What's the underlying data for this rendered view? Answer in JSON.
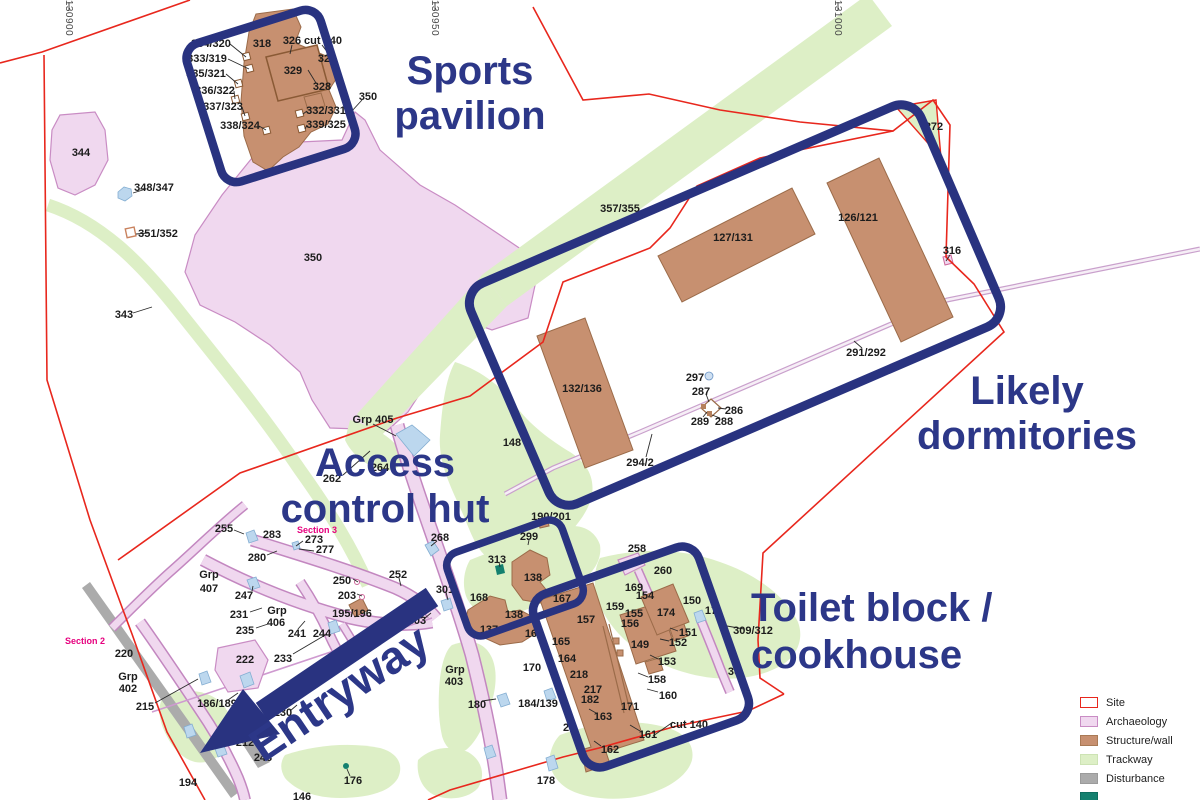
{
  "colors": {
    "annotation": "#2c3788",
    "highlight_box": "#293380",
    "site_boundary": "#e8271d",
    "archaeology": "#f0d8ef",
    "structure": "#c79070",
    "trackway": "#ddefc6",
    "disturbance": "#ababab",
    "section_label": "#e6007e",
    "teal": "#14806f"
  },
  "grid_labels": [
    {
      "text": "130900",
      "x": 66,
      "y": 18
    },
    {
      "text": "130950",
      "x": 432,
      "y": 18
    },
    {
      "text": "131000",
      "x": 835,
      "y": 18
    }
  ],
  "annotations": [
    {
      "name": "sports-pavilion",
      "lines": [
        "Sports",
        "pavilion"
      ],
      "x": 470,
      "y": 84,
      "size": 40,
      "lh": 45,
      "anchor": "middle",
      "rotate": 0
    },
    {
      "name": "likely-dormitories",
      "lines": [
        "Likely",
        "dormitories"
      ],
      "x": 1027,
      "y": 404,
      "size": 40,
      "lh": 45,
      "anchor": "middle",
      "rotate": 0
    },
    {
      "name": "access-control-hut",
      "lines": [
        "Access",
        "control hut"
      ],
      "x": 385,
      "y": 476,
      "size": 40,
      "lh": 46,
      "anchor": "middle",
      "rotate": 0
    },
    {
      "name": "toilet-block-cookhouse",
      "lines": [
        "Toilet block /",
        "cookhouse"
      ],
      "x": 751,
      "y": 621,
      "size": 40,
      "lh": 47,
      "anchor": "start",
      "rotate": 0
    },
    {
      "name": "entryway",
      "lines": [
        "Entryway"
      ],
      "x": 348,
      "y": 706,
      "size": 46,
      "lh": 46,
      "anchor": "middle",
      "rotate": -34
    }
  ],
  "legend": {
    "items": [
      {
        "label": "Site",
        "fill": "#ffffff",
        "border": "#e8271d"
      },
      {
        "label": "Archaeology",
        "fill": "#f0d8ef",
        "border": "#c98cc4"
      },
      {
        "label": "Structure/wall",
        "fill": "#c79070",
        "border": "#a97a55"
      },
      {
        "label": "Trackway",
        "fill": "#ddefc6",
        "border": "#cde3b4"
      },
      {
        "label": "Disturbance",
        "fill": "#ababab",
        "border": "#9b9b9b"
      },
      {
        "label": "",
        "fill": "#14806f",
        "border": "#0e6e60"
      }
    ]
  },
  "map_labels": [
    {
      "t": "334/320",
      "x": 211,
      "y": 43
    },
    {
      "t": "333/319",
      "x": 207,
      "y": 58
    },
    {
      "t": "335/321",
      "x": 206,
      "y": 73
    },
    {
      "t": "336/322",
      "x": 215,
      "y": 90
    },
    {
      "t": "337/323",
      "x": 223,
      "y": 106
    },
    {
      "t": "338/324",
      "x": 240,
      "y": 125
    },
    {
      "t": "318",
      "x": 262,
      "y": 43
    },
    {
      "t": "326",
      "x": 292,
      "y": 40
    },
    {
      "t": "cut 140",
      "x": 323,
      "y": 40
    },
    {
      "t": "32",
      "x": 324,
      "y": 58
    },
    {
      "t": "329",
      "x": 293,
      "y": 70
    },
    {
      "t": "328",
      "x": 322,
      "y": 86
    },
    {
      "t": "332/331",
      "x": 326,
      "y": 110
    },
    {
      "t": "339/325",
      "x": 326,
      "y": 124
    },
    {
      "t": "350",
      "x": 368,
      "y": 96
    },
    {
      "t": "344",
      "x": 81,
      "y": 152
    },
    {
      "t": "348/347",
      "x": 154,
      "y": 187
    },
    {
      "t": "351/352",
      "x": 158,
      "y": 233
    },
    {
      "t": "343",
      "x": 124,
      "y": 314
    },
    {
      "t": "350",
      "x": 313,
      "y": 257
    },
    {
      "t": "357/355",
      "x": 620,
      "y": 208
    },
    {
      "t": "127/131",
      "x": 733,
      "y": 237
    },
    {
      "t": "126/121",
      "x": 858,
      "y": 217
    },
    {
      "t": "316",
      "x": 952,
      "y": 250
    },
    {
      "t": "272",
      "x": 934,
      "y": 126
    },
    {
      "t": "291/292",
      "x": 866,
      "y": 352
    },
    {
      "t": "132/136",
      "x": 582,
      "y": 388
    },
    {
      "t": "297",
      "x": 695,
      "y": 377
    },
    {
      "t": "287",
      "x": 701,
      "y": 391
    },
    {
      "t": "286",
      "x": 734,
      "y": 410
    },
    {
      "t": "289",
      "x": 700,
      "y": 421
    },
    {
      "t": "288",
      "x": 724,
      "y": 421
    },
    {
      "t": "294/2",
      "x": 640,
      "y": 462
    },
    {
      "t": "148",
      "x": 512,
      "y": 442
    },
    {
      "t": "Grp 405",
      "x": 373,
      "y": 419
    },
    {
      "t": "262",
      "x": 332,
      "y": 478
    },
    {
      "t": "264",
      "x": 380,
      "y": 467
    },
    {
      "t": "255",
      "x": 224,
      "y": 528
    },
    {
      "t": "283",
      "x": 272,
      "y": 534
    },
    {
      "t": "Section 3",
      "x": 317,
      "y": 529,
      "c": "magenta"
    },
    {
      "t": "273",
      "x": 314,
      "y": 539
    },
    {
      "t": "277",
      "x": 325,
      "y": 549
    },
    {
      "t": "280",
      "x": 257,
      "y": 557
    },
    {
      "t": "268",
      "x": 440,
      "y": 537
    },
    {
      "t": "Grp",
      "x": 209,
      "y": 574
    },
    {
      "t": "407",
      "x": 209,
      "y": 588
    },
    {
      "t": "247",
      "x": 244,
      "y": 595
    },
    {
      "t": "231",
      "x": 239,
      "y": 614
    },
    {
      "t": "235",
      "x": 245,
      "y": 630
    },
    {
      "t": "Grp",
      "x": 277,
      "y": 610
    },
    {
      "t": "406",
      "x": 276,
      "y": 622
    },
    {
      "t": "241",
      "x": 297,
      "y": 633
    },
    {
      "t": "244",
      "x": 322,
      "y": 633
    },
    {
      "t": "250",
      "x": 342,
      "y": 580
    },
    {
      "t": "203",
      "x": 347,
      "y": 595
    },
    {
      "t": "195/196",
      "x": 352,
      "y": 613
    },
    {
      "t": "252",
      "x": 398,
      "y": 574
    },
    {
      "t": "301",
      "x": 445,
      "y": 589
    },
    {
      "t": "303",
      "x": 417,
      "y": 620
    },
    {
      "t": "222",
      "x": 245,
      "y": 659
    },
    {
      "t": "233",
      "x": 283,
      "y": 658
    },
    {
      "t": "220",
      "x": 124,
      "y": 653
    },
    {
      "t": "Section 2",
      "x": 85,
      "y": 640,
      "c": "magenta"
    },
    {
      "t": "Grp",
      "x": 128,
      "y": 676
    },
    {
      "t": "402",
      "x": 128,
      "y": 688
    },
    {
      "t": "215",
      "x": 145,
      "y": 706
    },
    {
      "t": "186/189",
      "x": 217,
      "y": 703
    },
    {
      "t": "230",
      "x": 283,
      "y": 712
    },
    {
      "t": "212",
      "x": 245,
      "y": 742
    },
    {
      "t": "243",
      "x": 263,
      "y": 757
    },
    {
      "t": "194",
      "x": 188,
      "y": 782
    },
    {
      "t": "176",
      "x": 353,
      "y": 780
    },
    {
      "t": "146",
      "x": 302,
      "y": 796
    },
    {
      "t": "Grp",
      "x": 455,
      "y": 669
    },
    {
      "t": "403",
      "x": 454,
      "y": 681
    },
    {
      "t": "180",
      "x": 477,
      "y": 704
    },
    {
      "t": "184/139",
      "x": 538,
      "y": 703
    },
    {
      "t": "178",
      "x": 546,
      "y": 780
    },
    {
      "t": "2",
      "x": 566,
      "y": 727
    },
    {
      "t": "190/201",
      "x": 551,
      "y": 516
    },
    {
      "t": "299",
      "x": 529,
      "y": 536
    },
    {
      "t": "313",
      "x": 497,
      "y": 559
    },
    {
      "t": "138",
      "x": 533,
      "y": 577
    },
    {
      "t": "168",
      "x": 479,
      "y": 597
    },
    {
      "t": "138",
      "x": 514,
      "y": 614
    },
    {
      "t": "137",
      "x": 489,
      "y": 629
    },
    {
      "t": "167",
      "x": 562,
      "y": 598
    },
    {
      "t": "166",
      "x": 534,
      "y": 633
    },
    {
      "t": "157",
      "x": 586,
      "y": 619
    },
    {
      "t": "159",
      "x": 615,
      "y": 606
    },
    {
      "t": "155",
      "x": 634,
      "y": 613
    },
    {
      "t": "156",
      "x": 630,
      "y": 623
    },
    {
      "t": "154",
      "x": 645,
      "y": 595
    },
    {
      "t": "169",
      "x": 634,
      "y": 587
    },
    {
      "t": "174",
      "x": 666,
      "y": 612
    },
    {
      "t": "150",
      "x": 692,
      "y": 600
    },
    {
      "t": "17",
      "x": 711,
      "y": 610
    },
    {
      "t": "151",
      "x": 688,
      "y": 632
    },
    {
      "t": "152",
      "x": 678,
      "y": 642
    },
    {
      "t": "149",
      "x": 640,
      "y": 644
    },
    {
      "t": "153",
      "x": 667,
      "y": 661
    },
    {
      "t": "309/312",
      "x": 753,
      "y": 630
    },
    {
      "t": "158",
      "x": 657,
      "y": 679
    },
    {
      "t": "160",
      "x": 668,
      "y": 695
    },
    {
      "t": "161",
      "x": 648,
      "y": 734
    },
    {
      "t": "162",
      "x": 610,
      "y": 749
    },
    {
      "t": "163",
      "x": 603,
      "y": 716
    },
    {
      "t": "171",
      "x": 630,
      "y": 706
    },
    {
      "t": "218",
      "x": 579,
      "y": 674
    },
    {
      "t": "217",
      "x": 593,
      "y": 689
    },
    {
      "t": "182",
      "x": 590,
      "y": 699
    },
    {
      "t": "164",
      "x": 567,
      "y": 658
    },
    {
      "t": "165",
      "x": 561,
      "y": 641
    },
    {
      "t": "170",
      "x": 532,
      "y": 667
    },
    {
      "t": "cut 140",
      "x": 689,
      "y": 724
    },
    {
      "t": "30",
      "x": 734,
      "y": 671
    },
    {
      "t": "258",
      "x": 637,
      "y": 548
    },
    {
      "t": "260",
      "x": 663,
      "y": 570
    }
  ]
}
